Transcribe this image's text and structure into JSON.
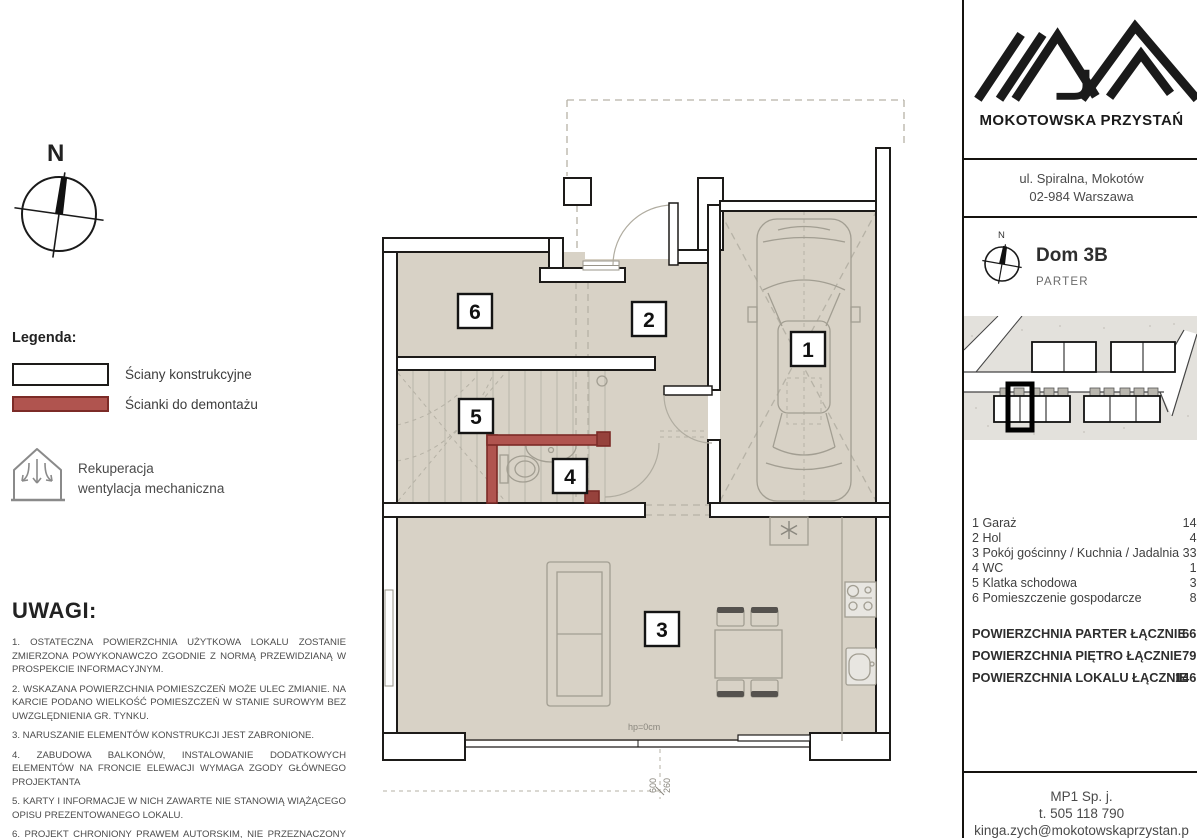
{
  "brand": {
    "name": "MOKOTOWSKA PRZYSTAŃ",
    "address_line1": "ul. Spiralna, Mokotów",
    "address_line2": "02-984 Warszawa"
  },
  "unit": {
    "title": "Dom 3B",
    "floor": "PARTER",
    "compass_label": "N"
  },
  "north": {
    "label": "N"
  },
  "legend": {
    "heading": "Legenda:",
    "wall_label": "Ściany konstrukcyjne",
    "demolition_label": "Ścianki do demontażu",
    "recuperation_line1": "Rekuperacja",
    "recuperation_line2": "wentylacja mechaniczna"
  },
  "plan": {
    "labels": [
      "1",
      "2",
      "3",
      "4",
      "5",
      "6"
    ],
    "window_label": "hp=0cm",
    "dim_width": "600",
    "dim_height": "260"
  },
  "rooms": [
    {
      "no": "1",
      "name": "Garaż",
      "area": "14,8"
    },
    {
      "no": "2",
      "name": "Hol",
      "area": "4,3"
    },
    {
      "no": "3",
      "name": "Pokój gościnny / Kuchnia / Jadalnia",
      "area": "33,1"
    },
    {
      "no": "4",
      "name": "WC",
      "area": "1,7"
    },
    {
      "no": "5",
      "name": "Klatka schodowa",
      "area": "3,9"
    },
    {
      "no": "6",
      "name": "Pomieszczenie gospodarcze",
      "area": "8,5"
    }
  ],
  "totals": [
    {
      "label": "POWIERZCHNIA PARTER ŁĄCZNIE",
      "value": "66,5"
    },
    {
      "label": "POWIERZCHNIA PIĘTRO ŁĄCZNIE",
      "value": "79,7"
    },
    {
      "label": "POWIERZCHNIA LOKALU ŁĄCZNIE",
      "value": "146,3"
    }
  ],
  "notes": {
    "heading": "UWAGI:",
    "items": [
      "1. OSTATECZNA POWIERZCHNIA UŻYTKOWA LOKALU ZOSTANIE ZMIERZONA POWYKONAWCZO ZGODNIE Z NORMĄ PRZEWIDZIANĄ W PROSPEKCIE INFORMACYJNYM.",
      "2. WSKAZANA POWIERZCHNIA POMIESZCZEŃ MOŻE ULEC ZMIANIE. NA KARCIE PODANO WIELKOŚĆ POMIESZCZEŃ W STANIE SUROWYM BEZ UWZGLĘDNIENIA GR. TYNKU.",
      "3. NARUSZANIE ELEMENTÓW KONSTRUKCJI JEST ZABRONIONE.",
      "4. ZABUDOWA BALKONÓW, INSTALOWANIE DODATKOWYCH ELEMENTÓW NA FRONCIE ELEWACJI WYMAGA ZGODY GŁÓWNEGO PROJEKTANTA",
      "5. KARTY I INFORMACJE W NICH ZAWARTE NIE STANOWIĄ WIĄŻĄCEGO OPISU PREZENTOWANEGO LOKALU.",
      "6. PROJEKT CHRONIONY PRAWEM AUTORSKIM, NIE PRZEZNACZONY DO CELÓW WYKONAWCZYCH"
    ]
  },
  "contact": {
    "company": "MP1 Sp. j.",
    "phone": "t. 505 118 790",
    "email": "kinga.zych@mokotowskaprzystan.p"
  },
  "colors": {
    "floor": "#d8d2c6",
    "demolition_wall": "#b0544f",
    "wall_outline": "#1d1b19"
  }
}
